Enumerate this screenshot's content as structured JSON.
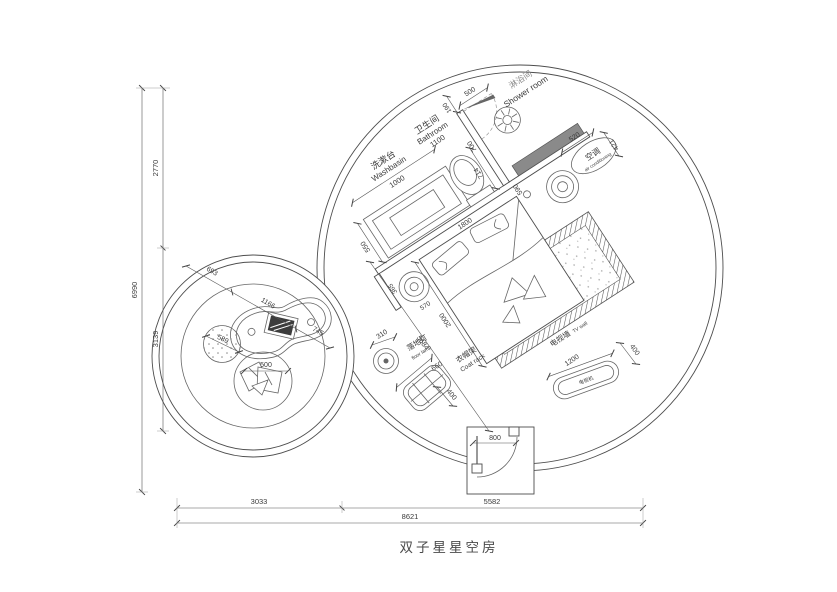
{
  "title": "双子星星空房",
  "dim_left": {
    "overall": "6990",
    "top": "2770",
    "bottom": "3139"
  },
  "dim_bottom": {
    "left": "3033",
    "right": "5582",
    "overall": "8621"
  },
  "bathroom": {
    "washbasin_cn": "洗漱台",
    "washbasin_en": "Washbasin",
    "washbasin_width": "1000",
    "vanity_depth": "550",
    "room_cn": "卫生间",
    "room_en": "Bathroom",
    "room_width": "1100",
    "d190": "190",
    "d700": "700",
    "door_width": "500",
    "d590": "590",
    "d714": "714"
  },
  "shower": {
    "cn": "淋浴间",
    "en": "Shower room"
  },
  "ac": {
    "cn": "空调",
    "en": "air conditioning",
    "d520": "520",
    "d421": "421"
  },
  "bed": {
    "width": "1800",
    "length": "2000",
    "diag": "5684",
    "side_a": "365",
    "side_b": "570"
  },
  "tv": {
    "wall_cn": "电视墙",
    "wall_en": "TV wall",
    "set_cn": "电视机",
    "length": "1200",
    "depth": "400"
  },
  "coat": {
    "cn": "衣帽架",
    "en": "Coat rack",
    "width": "660",
    "depth": "400"
  },
  "lamp": {
    "cn": "落地灯",
    "en": "floor lamp",
    "offset": "310"
  },
  "door": {
    "width": "800"
  },
  "lounge": {
    "d693": "693",
    "d1166": "1166",
    "d745": "745",
    "pouf": "589",
    "chair": "500"
  }
}
